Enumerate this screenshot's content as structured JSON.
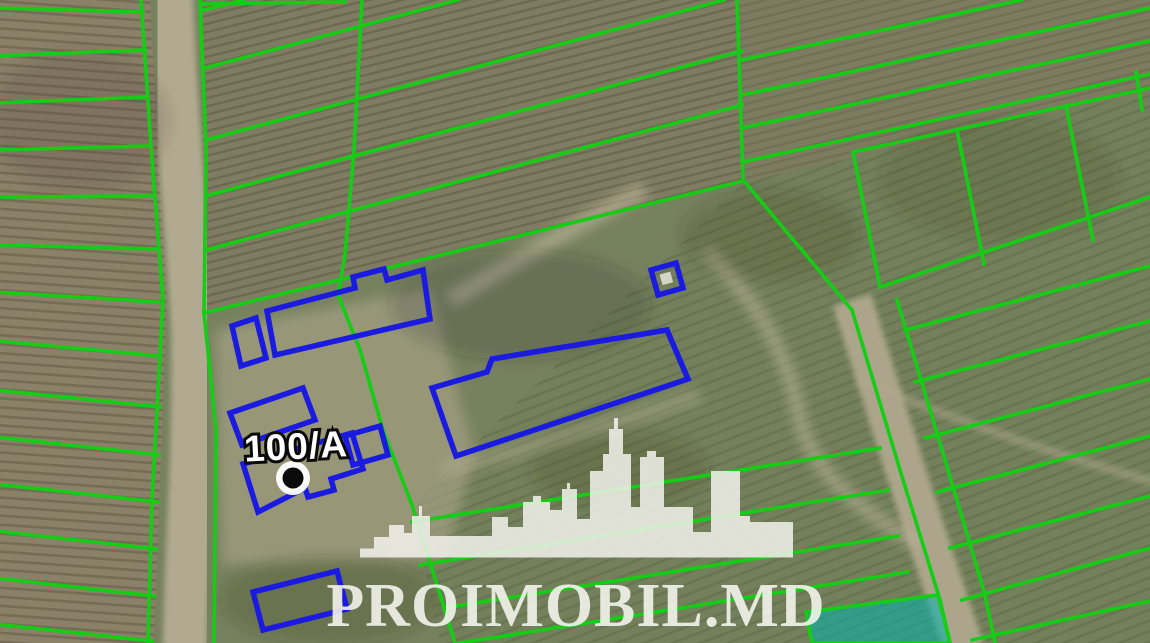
{
  "map": {
    "parcel_label": "100/A",
    "marker": "black-dot-marker",
    "overlay_colors": {
      "cadastral_line_green": "#14cd14",
      "building_outline_blue": "#1a1ae0",
      "highlighted_parcel_teal": "#00b4ae"
    }
  },
  "watermark": {
    "brand_text": "PROIMOBIL.MD",
    "logo": "city-skyline"
  }
}
